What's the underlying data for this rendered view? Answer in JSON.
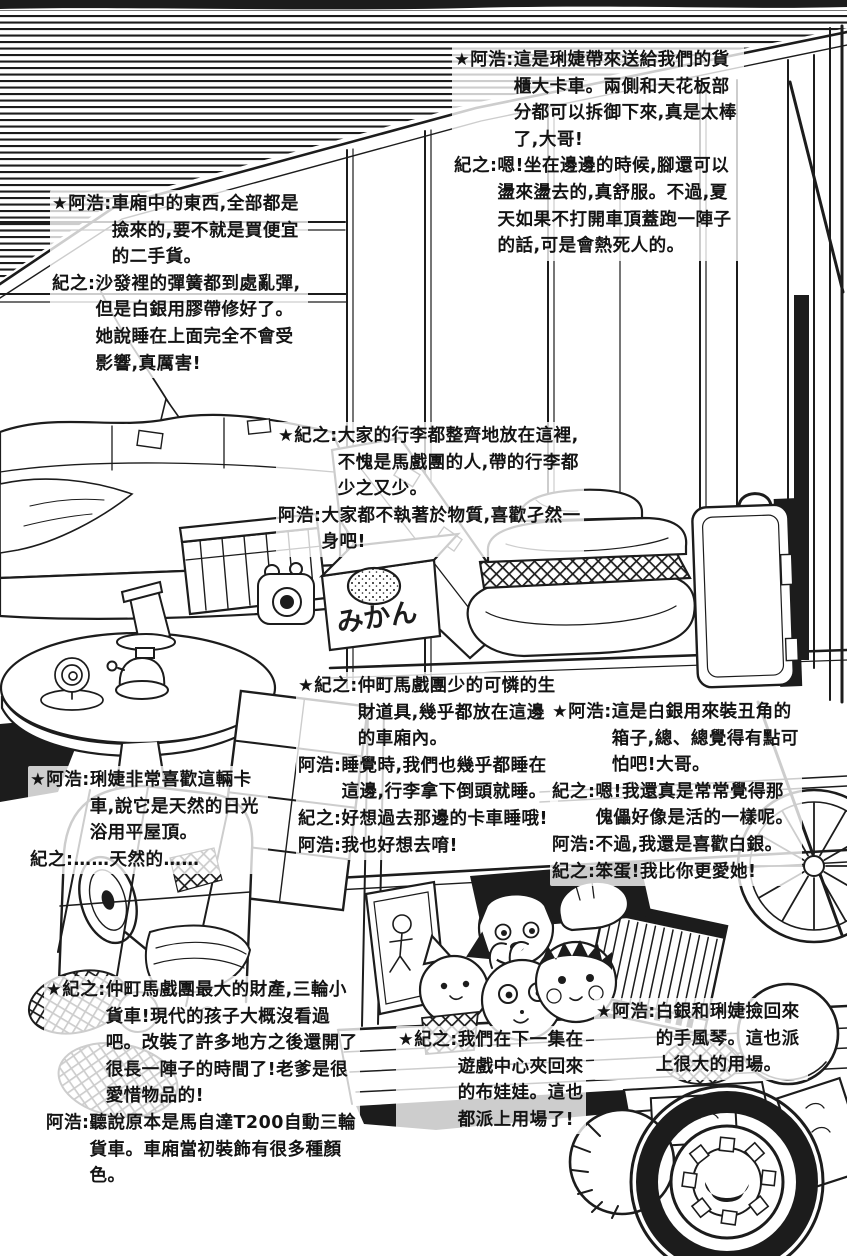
{
  "page": {
    "paper": "#ffffff",
    "ink": "#1c1c1c"
  },
  "illustration": {
    "mikan_label": "みかん"
  },
  "captions": [
    {
      "id": "container-truck",
      "lines": [
        {
          "speaker": "★阿浩:",
          "text": "這是琍婕帶來送給我們的貨櫃大卡車。兩側和天花板部分都可以拆御下來,真是太棒了,大哥!"
        },
        {
          "speaker": "紀之:",
          "text": "嗯!坐在邊邊的時候,腳還可以盪來盪去的,真舒服。不過,夏天如果不打開車頂蓋跑一陣子的話,可是會熱死人的。"
        }
      ]
    },
    {
      "id": "cabin-contents",
      "lines": [
        {
          "speaker": "★阿浩:",
          "text": "車廂中的東西,全部都是撿來的,要不就是買便宜的二手貨。"
        },
        {
          "speaker": "紀之:",
          "text": "沙發裡的彈簧都到處亂彈,但是白銀用膠帶修好了。她說睡在上面完全不會受影響,真厲害!"
        }
      ]
    },
    {
      "id": "luggage",
      "lines": [
        {
          "speaker": "★紀之:",
          "text": "大家的行李都整齊地放在這裡,不愧是馬戲團的人,帶的行李都少之又少。"
        },
        {
          "speaker": "阿浩:",
          "text": "大家都不執著於物質,喜歡孑然一身吧!"
        }
      ]
    },
    {
      "id": "cargo-bed",
      "lines": [
        {
          "speaker": "★紀之:",
          "text": "仲町馬戲團少的可憐的生財道具,幾乎都放在這邊的車廂內。"
        },
        {
          "speaker": "阿浩:",
          "text": "睡覺時,我們也幾乎都睡在這邊,行李拿下倒頭就睡。"
        },
        {
          "speaker": "紀之:",
          "text": "好想過去那邊的卡車睡哦!"
        },
        {
          "speaker": "阿浩:",
          "text": "我也好想去唷!"
        }
      ]
    },
    {
      "id": "clown-box",
      "lines": [
        {
          "speaker": "★阿浩:",
          "text": "這是白銀用來裝丑角的箱子,總、總覺得有點可怕吧!大哥。"
        },
        {
          "speaker": "紀之:",
          "text": "嗯!我還真是常常覺得那傀儡好像是活的一樣呢。"
        },
        {
          "speaker": "阿浩:",
          "text": "不過,我還是喜歡白銀。"
        },
        {
          "speaker": "紀之:",
          "text": "笨蛋!我比你更愛她!"
        }
      ]
    },
    {
      "id": "flat-roof",
      "lines": [
        {
          "speaker": "★阿浩:",
          "text": "琍婕非常喜歡這輛卡車,說它是天然的日光浴用平屋頂。"
        },
        {
          "speaker": "紀之:",
          "text": "……天然的……"
        }
      ]
    },
    {
      "id": "three-wheeler",
      "lines": [
        {
          "speaker": "★紀之:",
          "text": "仲町馬戲團最大的財產,三輪小貨車!現代的孩子大概沒看過吧。改裝了許多地方之後還開了很長一陣子的時間了!老爹是很愛惜物品的!"
        },
        {
          "speaker": "阿浩:",
          "text": "聽說原本是馬自達T200自動三輪貨車。車廂當初裝飾有很多種顏色。"
        }
      ]
    },
    {
      "id": "plush-toys",
      "lines": [
        {
          "speaker": "★紀之:",
          "text": "我們在下一集在遊戲中心夾回來的布娃娃。這也都派上用場了!"
        }
      ]
    },
    {
      "id": "accordion",
      "lines": [
        {
          "speaker": "★阿浩:",
          "text": "白銀和琍婕撿回來的手風琴。這也派上很大的用場。"
        }
      ]
    }
  ]
}
